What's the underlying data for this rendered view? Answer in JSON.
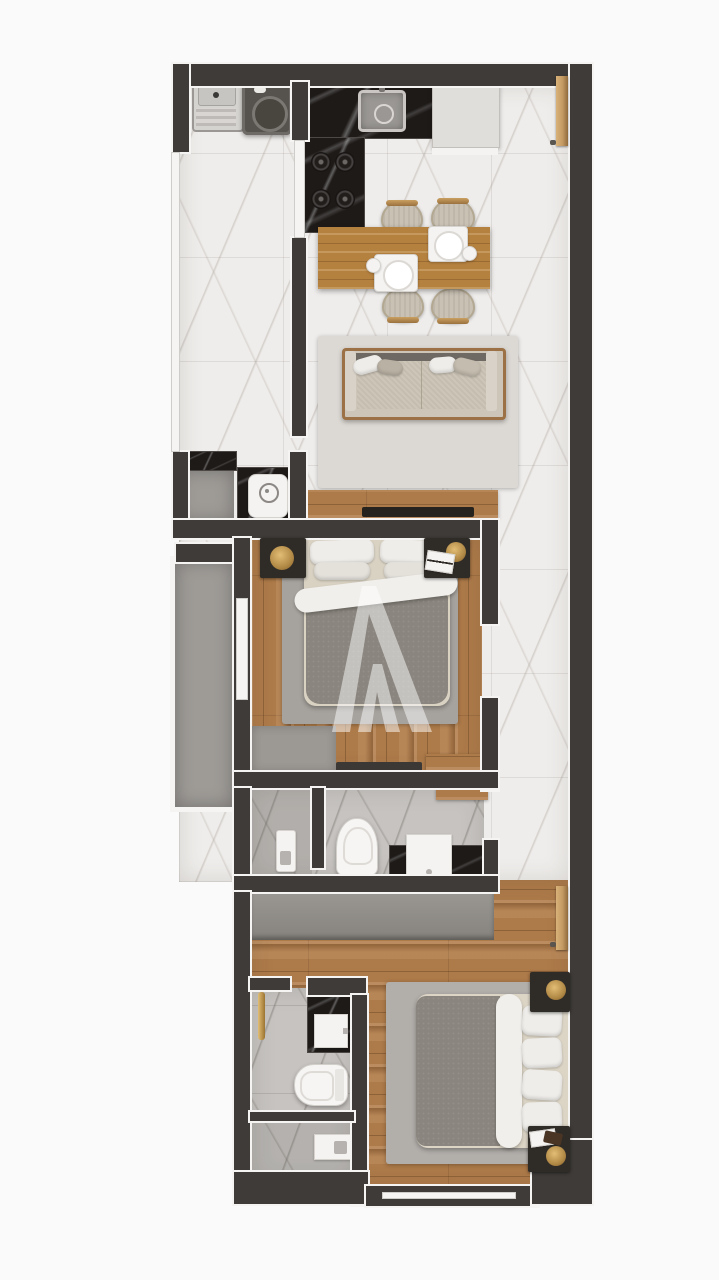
{
  "page": {
    "type": "3d-floor-plan-render",
    "view": "top-down",
    "background": "#fbfafa",
    "visible_text": "none"
  },
  "palette": {
    "wall": "#3e3b38",
    "outline": "#f5f4f2",
    "marble": "#efedeb",
    "marbleGray": "#c6c3c0",
    "marbleGray2": "#b8b5b2",
    "concrete": "#9e9b97",
    "wood": "#ad7a49",
    "tableWood": "#b5813f",
    "blackMarble": "#1d1a18",
    "rugLiving": "#dcd8d3",
    "rugBed1": "#a6a29d",
    "rugBed2": "#b2aeaa",
    "duvet": "#8a857e",
    "pillow": "#efede9",
    "sheet": "#d9d2c3",
    "sofaCushion": "#cdc5b7",
    "sofaBack": "#6f6963",
    "nightstand": "#2f2b27",
    "gold": "#b08845",
    "white": "#f4f3f1",
    "appliance": "#e0deda",
    "washerDark": "#56524e",
    "doorWood": "#c49a63",
    "tv": "#26231f",
    "wardrobe": "#93908b",
    "matGray": "#9c9894",
    "pageBg": "#fbfafa"
  },
  "watermark": {
    "shape": "stylized-letter-A",
    "color": "#ffffff",
    "opacity": 0.5
  },
  "rooms": [
    {
      "name": "laundry-nook",
      "floor": "white-marble",
      "furniture": [
        "utility-sink",
        "washing-machine"
      ]
    },
    {
      "name": "kitchen",
      "floor": "white-marble",
      "furniture": [
        "black-marble-counter",
        "kitchen-sink",
        "cooktop-4-burners",
        "refrigerator"
      ]
    },
    {
      "name": "dining-area",
      "floor": "white-marble",
      "furniture": [
        "wood-dining-table",
        "chair",
        "chair",
        "chair",
        "chair",
        "place-setting",
        "place-setting"
      ]
    },
    {
      "name": "living-area",
      "floor": "white-marble",
      "furniture": [
        "area-rug",
        "sofa",
        "tv-console",
        "tv"
      ]
    },
    {
      "name": "utility-niche",
      "floor": "black-marble-counter",
      "furniture": [
        "washing-machine-top"
      ]
    },
    {
      "name": "service-balcony",
      "floor": "gray-concrete",
      "furniture": [
        "black-marble-counter"
      ]
    },
    {
      "name": "balcony",
      "floor": "gray-concrete",
      "furniture": []
    },
    {
      "name": "bedroom-1",
      "floor": "wood-planks",
      "furniture": [
        "double-bed",
        "nightstand",
        "nightstand",
        "area-rug",
        "wardrobe-mat",
        "wood-bench"
      ]
    },
    {
      "name": "bathroom-1",
      "floor": "gray-marble",
      "furniture": [
        "toilet",
        "vanity-with-sink",
        "shower-panel",
        "wood-shelf"
      ]
    },
    {
      "name": "hallway",
      "floor": "white-marble",
      "furniture": [
        "entry-door"
      ]
    },
    {
      "name": "bedroom-2",
      "floor": "wood-planks",
      "furniture": [
        "double-bed",
        "nightstand",
        "nightstand",
        "area-rug",
        "wardrobe",
        "door"
      ]
    },
    {
      "name": "bathroom-2",
      "floor": "gray-marble",
      "furniture": [
        "toilet",
        "vanity-with-sink",
        "shower-tray",
        "gold-towel-rail"
      ]
    }
  ]
}
